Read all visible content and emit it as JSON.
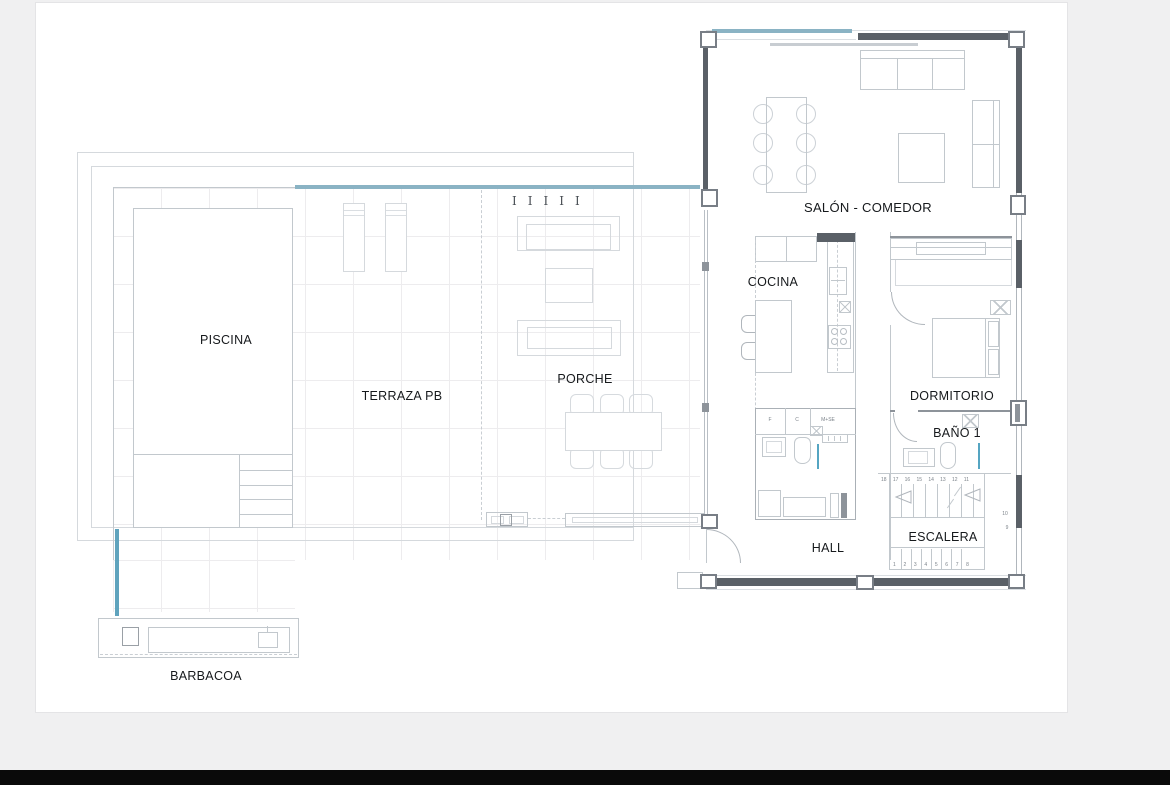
{
  "plan": {
    "rooms": {
      "piscina": "PISCINA",
      "terraza": "TERRAZA PB",
      "porche": "PORCHE",
      "barbacoa": "BARBACOA",
      "salon": "SALÓN - COMEDOR",
      "cocina": "COCINA",
      "dormitorio": "DORMITORIO",
      "bano": "BAÑO 1",
      "hall": "HALL",
      "escalera": "ESCALERA"
    },
    "stairs": {
      "top": [
        "18",
        "17",
        "16",
        "15",
        "14",
        "13",
        "12",
        "11"
      ],
      "bottom": [
        "1",
        "2",
        "3",
        "4",
        "5",
        "6",
        "7",
        "8"
      ],
      "side": [
        "10",
        "9"
      ]
    },
    "utility_labels": [
      "F",
      "C",
      "M+SE"
    ],
    "column_markers": "IIIII",
    "colors": {
      "accent_blue": "#8ab3c4",
      "accent_blue_strong": "#5fa3bd",
      "wall_dark": "#5a6067"
    }
  }
}
